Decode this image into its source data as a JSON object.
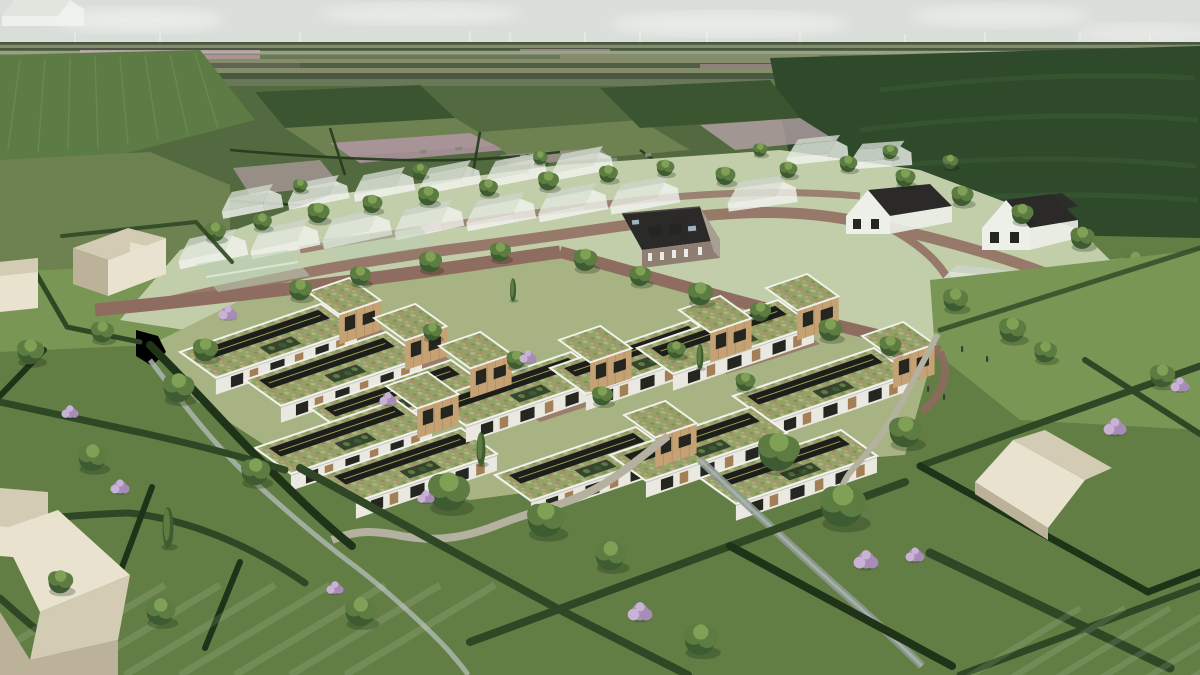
{
  "scene": {
    "type": "architectural-aerial-rendering",
    "description": "Aerial architectural visualisation of a new courtyard housing development with timber-clad two-storey cubes, linked single-storey dwellings with sedum green roofs and black solar-panel strips, brick streets and stone footpaths, set in hedged meadows with trees, flowering shrubs and drainage ditches. Behind it lies an existing village shown as translucent white massing models with a few detailed houses (a brick farmhouse with dark roof and two white houses with black roofs), translucent glass barns, and beyond that flat polder farmland with green fields, pink flower fields and a row of distant wind turbines under a pale overcast sky. Simple cream massing houses sit at the left edge, bottom-left corner and in a hedged paddock at the right.",
    "features": [
      "overcast sky",
      "wind turbines on horizon",
      "patchwork polder fields",
      "pink bulb fields",
      "ghosted village massing houses",
      "brick farmhouse with dormers",
      "white houses with black roofs",
      "translucent glass barns",
      "timber cube houses with sedum roofs",
      "single-storey rows with solar panels and sedum roofs",
      "brick street loop",
      "stone footpaths",
      "pond and meandering stream",
      "drainage ditch",
      "trimmed hedge lattice",
      "meadow trees",
      "purple flowering shrubs",
      "cream massing houses",
      "pedestrians on footpath"
    ]
  },
  "palette": {
    "sky": "#dadedb",
    "cloud": "#ebedea",
    "turbine": "#f4f5f2",
    "distantDark": "#4a5840",
    "distantMid": "#697858",
    "distantLight": "#848c6c",
    "distantPale": "#9aa083",
    "pink1": "#b697a7",
    "pink2": "#c5a9b6",
    "fieldBright": "#5d7b45",
    "fieldDark": "#2e4a2b",
    "hedgerow": "#24381f",
    "mowDark": "#3b5c34",
    "midGreen": "#53693f",
    "midGreenDark": "#3c5531",
    "midGreenLight": "#6e8251",
    "villageGround": "#c2cdaa",
    "villageRoad": "#97796a",
    "ghostWall": "#f3f5f1",
    "ghostRoof": "#e2e8de",
    "ghostRoofBack": "#cdd6ca",
    "brickWall": "#8e7f72",
    "brickWallLight": "#a89f93",
    "darkRoof": "#2b2a28",
    "whiteWall": "#edefe9",
    "skylight": "#9fb3c0",
    "glass": "#b9cfb4",
    "devStreet": "#8e6c5f",
    "courtBrick": "#997868",
    "stonePath": "#b4b1a0",
    "courtGrass": "#a7b382",
    "grass": "#627e44",
    "grassLight": "#7a9655",
    "rowWall": "#e9e9e2",
    "rowWallShade": "#d6d6cc",
    "parapet": "#f1f2ec",
    "sedum": "#93a368",
    "sedumLight": "#b4b083",
    "sedumBrown": "#a9906c",
    "sedumDark": "#7d9355",
    "solar": "#1d1e1c",
    "solarLine": "#9fa84e",
    "patio": "#37452e",
    "wood": "#c4a274",
    "woodShade": "#a37f55",
    "woodDark": "#7c5f3f",
    "windowDark": "#24261f",
    "hedge": "#2f4724",
    "hedgeDark": "#1f3318",
    "treeDark": "#3e5c31",
    "treeMid": "#5c7c41",
    "treeLight": "#7fa055",
    "trunk": "#463b2c",
    "water": "#8d9a92",
    "waterLight": "#adb6ad",
    "cream": "#e8e2cf",
    "creamShade": "#d3cbb4",
    "creamDark": "#bcb29a",
    "purple": "#a78cb8",
    "purpleLight": "#c8b2d6",
    "person": "#3c3c38"
  }
}
